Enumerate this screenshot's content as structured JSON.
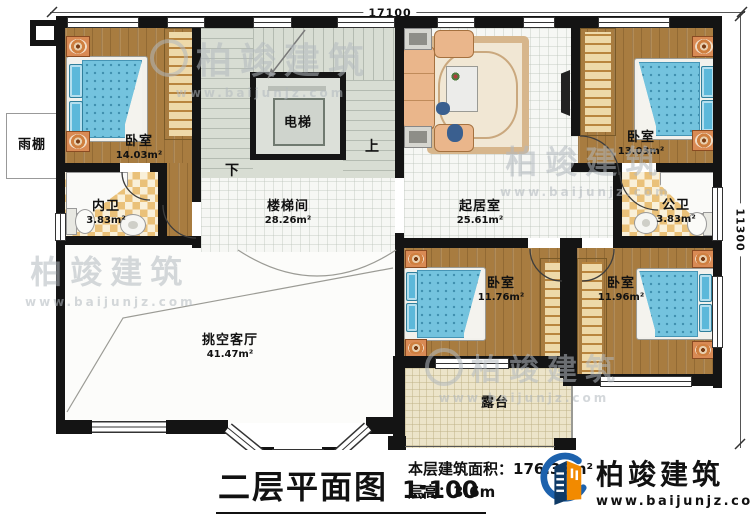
{
  "dimensions": {
    "top": "17100",
    "right": "11300"
  },
  "rooms": {
    "bedroom_tl": {
      "name": "卧室",
      "area": "14.03m²"
    },
    "bath_inner": {
      "name": "内卫",
      "area": "3.83m²"
    },
    "elevator": {
      "name": "电梯"
    },
    "stairwell": {
      "name": "楼梯间",
      "area": "28.26m²"
    },
    "living": {
      "name": "起居室",
      "area": "25.61m²"
    },
    "bedroom_tr": {
      "name": "卧室",
      "area": "13.03m²"
    },
    "bath_public": {
      "name": "公卫",
      "area": "3.83m²"
    },
    "void_living": {
      "name": "挑空客厅",
      "area": "41.47m²"
    },
    "bedroom_bl": {
      "name": "卧室",
      "area": "11.76m²"
    },
    "bedroom_br": {
      "name": "卧室",
      "area": "11.96m²"
    },
    "terrace": {
      "name": "露台"
    },
    "canopy": {
      "name": "雨棚"
    }
  },
  "stairs": {
    "up": "上",
    "down": "下"
  },
  "titleblock": {
    "title": "二层平面图",
    "scale": "1:100",
    "area_label": "本层建筑面积：",
    "area_value": "176.35m²",
    "height_label": "层高：",
    "height_value": "3.6m"
  },
  "brand": {
    "name": "柏竣建筑",
    "url": "www.baijunjz.com"
  },
  "watermark": {
    "name": "柏竣建筑",
    "url": "www.baijunjz.com"
  },
  "colors": {
    "wall": "#141414",
    "wood": "#a87c40",
    "bed_blue": "#74c3de",
    "stair": "#d8ddd3",
    "tile": "#f6f7f4",
    "checker": "#eac179",
    "terrace": "#ece4c9",
    "brand_blue": "#1d62ad",
    "brand_orange": "#f28a00"
  }
}
